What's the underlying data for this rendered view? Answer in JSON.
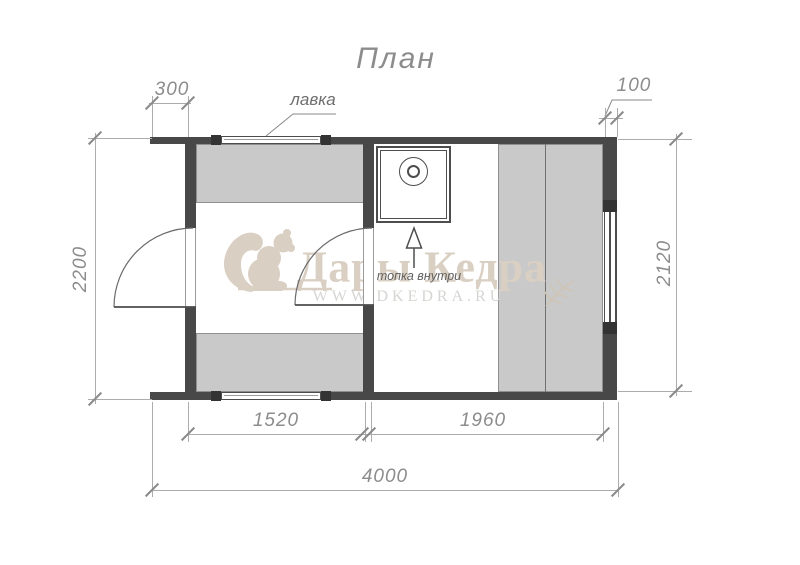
{
  "title": "План",
  "labels": {
    "bench": "лавка",
    "stove_note": "топка внутри"
  },
  "dimensions": {
    "top_left_offset": "300",
    "top_right_wall": "100",
    "left_height": "2200",
    "right_height": "2120",
    "washroom_width": "1520",
    "steamroom_width": "1960",
    "total_width": "4000"
  },
  "watermark": {
    "brand": "Дары Кедра",
    "url": "WWW.DKEDRA.RU"
  },
  "colors": {
    "wall": "#484848",
    "wall_block": "#333333",
    "bench_fill": "#c9c9c9",
    "bench_border": "#8f8f8f",
    "plan_line": "#4d4d4d",
    "dim_line": "#acacac",
    "dim_text": "#8c8c8c",
    "watermark_tan": "#d9cfc2",
    "watermark_url": "#d6d5d2"
  }
}
